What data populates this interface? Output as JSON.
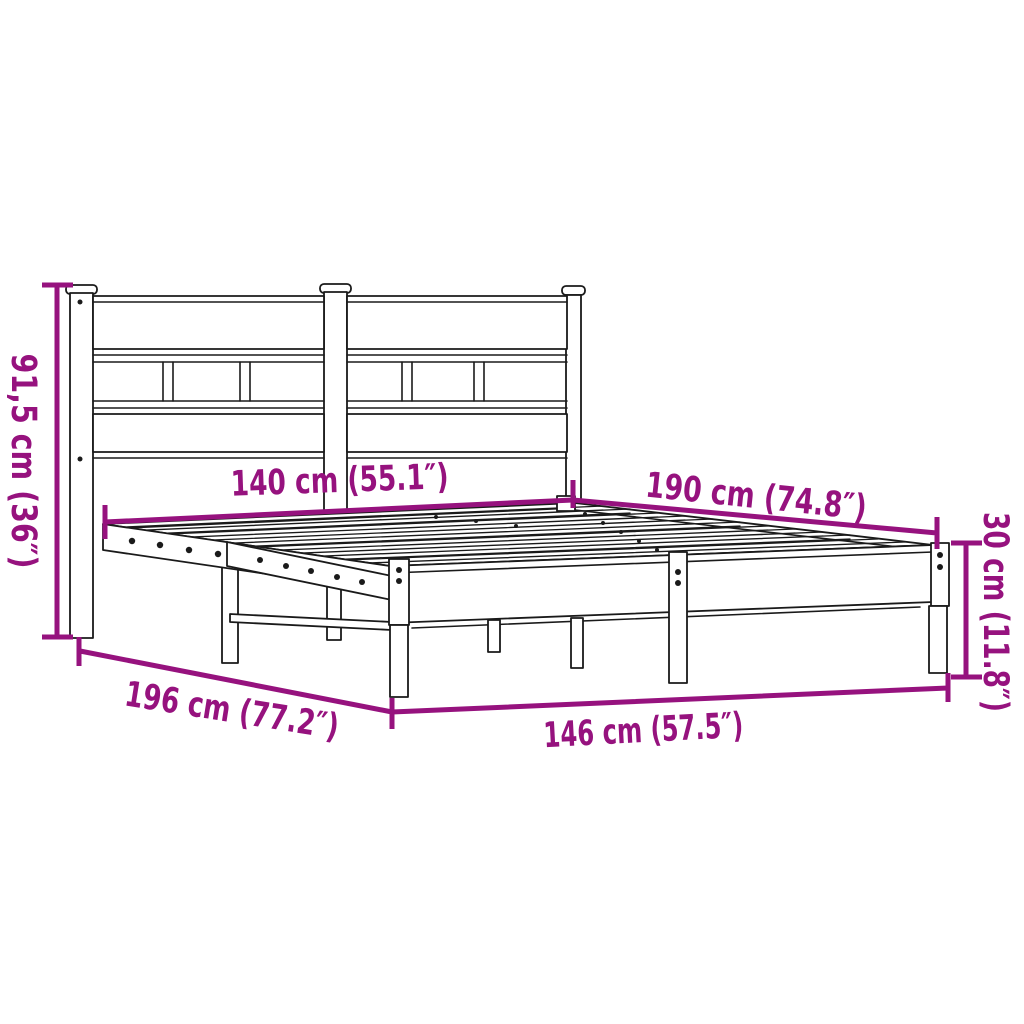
{
  "theme": {
    "accent_color": "#96127E",
    "line_color": "#1a1a1a",
    "background": "#ffffff"
  },
  "diagram": {
    "subject": "metal bed frame with headboard",
    "dimensions": [
      {
        "id": "headboard-height",
        "label": "91,5 cm (36″)",
        "value_cm": "91,5",
        "value_in": "36"
      },
      {
        "id": "bed-width",
        "label": "140 cm (55.1″)",
        "value_cm": "140",
        "value_in": "55.1"
      },
      {
        "id": "bed-length",
        "label": "190 cm (74.8″)",
        "value_cm": "190",
        "value_in": "74.8"
      },
      {
        "id": "frame-height",
        "label": "30 cm (11.8″)",
        "value_cm": "30",
        "value_in": "11.8"
      },
      {
        "id": "total-length",
        "label": "196 cm (77.2″)",
        "value_cm": "196",
        "value_in": "77.2"
      },
      {
        "id": "total-width",
        "label": "146 cm (57.5″)",
        "value_cm": "146",
        "value_in": "57.5"
      }
    ]
  }
}
